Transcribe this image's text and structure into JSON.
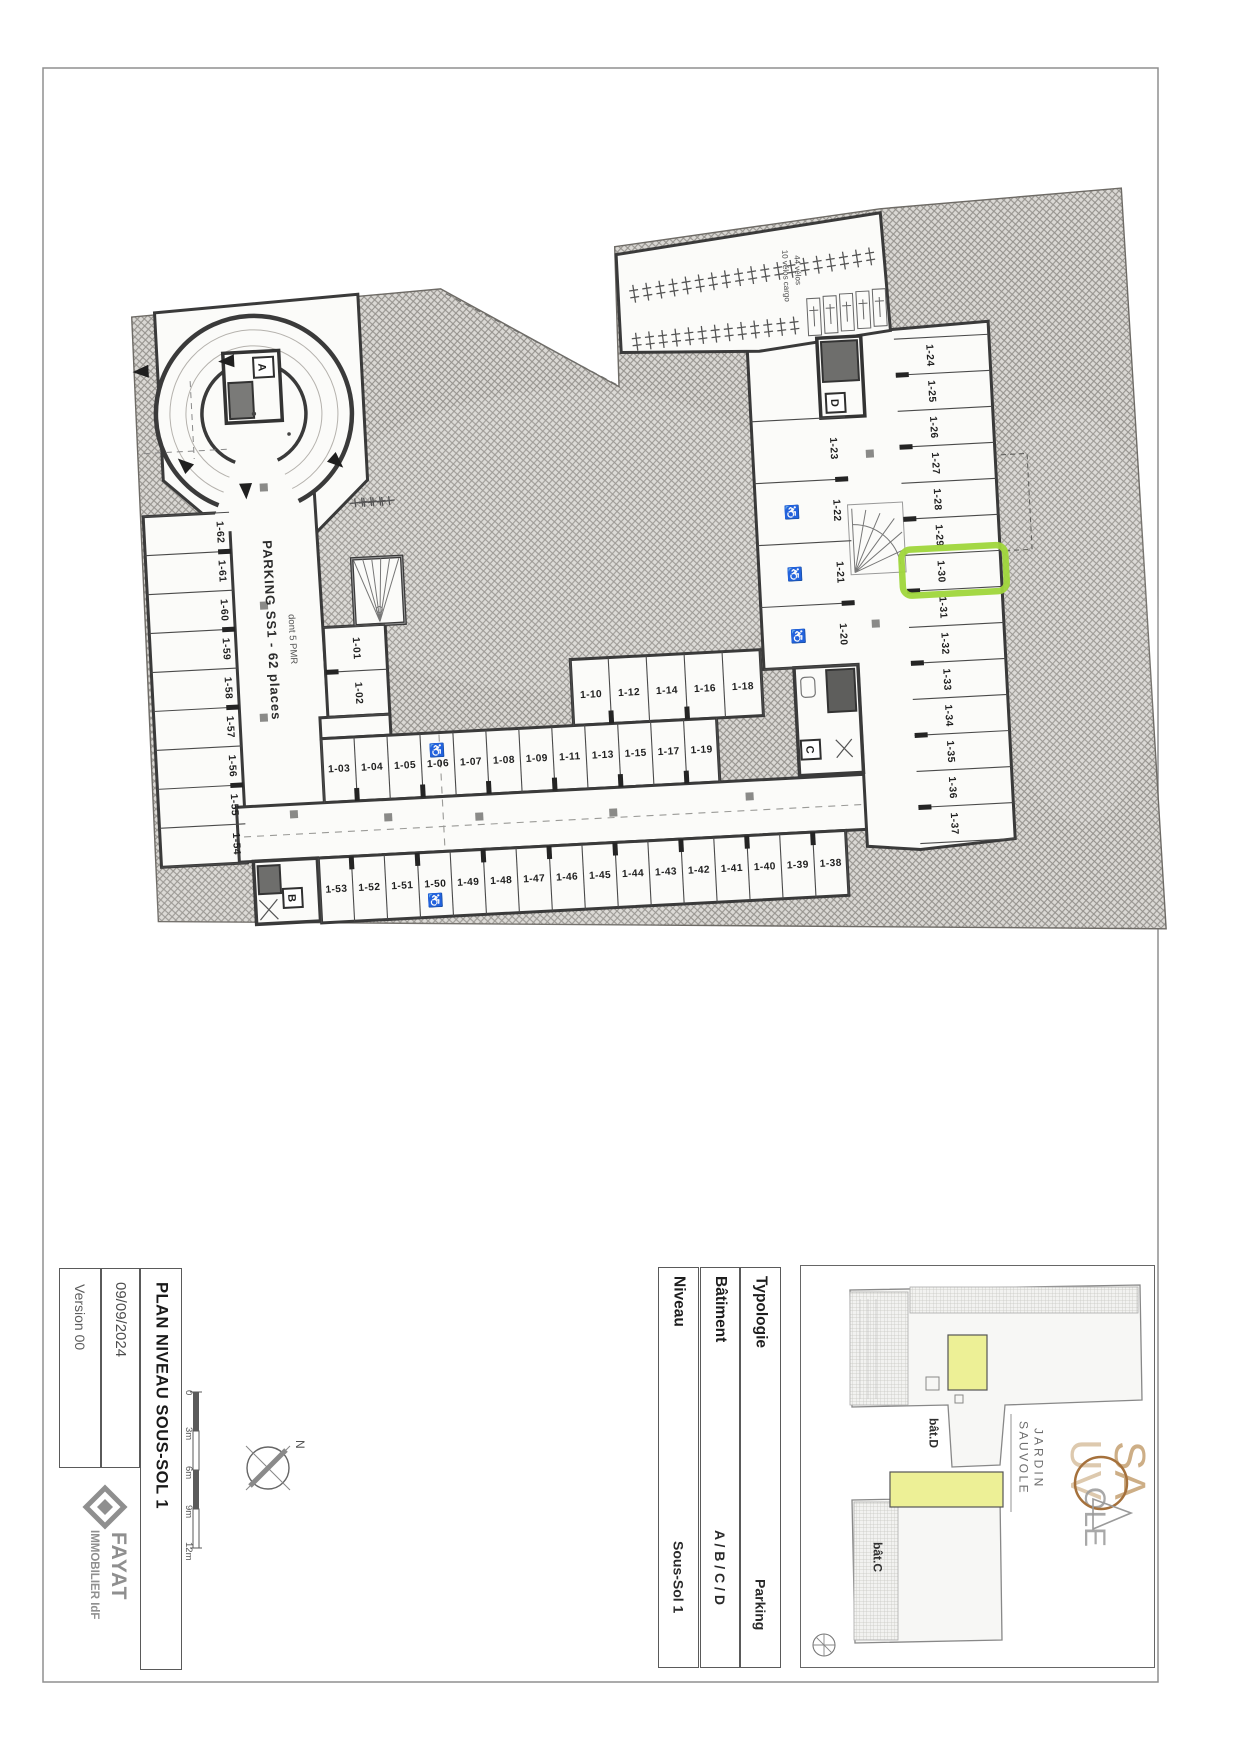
{
  "document": {
    "title": "PLAN NIVEAU SOUS-SOL 1",
    "date": "09/09/2024",
    "version": "Version 00",
    "logo": {
      "brand": "FAYAT",
      "sub": "IMMOBILIER IdF"
    },
    "scale_bar": {
      "ticks": [
        "0",
        "3m",
        "6m",
        "9m",
        "12m"
      ]
    },
    "compass_label": "N",
    "fields": [
      {
        "label": "Typologie",
        "value": "Parking"
      },
      {
        "label": "Bâtiment",
        "value": "A / B / C / D"
      },
      {
        "label": "Niveau",
        "value": "Sous-Sol 1"
      }
    ],
    "key_plan": {
      "labels": [
        "bât.D",
        "bât.C"
      ],
      "highlight_color": "#edf096"
    },
    "project_logo": {
      "line1": "JARDIN",
      "line2": "SAUVOLE",
      "monogram": [
        "SA",
        "UV",
        "OLE"
      ]
    }
  },
  "plan": {
    "parking_label": "PARKING SS1 - 62 places",
    "parking_sublabel": "dont 5 PMR",
    "bike_labels": [
      "10 vélos cargo",
      "44 vélos"
    ],
    "highlighted_space": "1-30",
    "highlight_color": "#9fd63b",
    "cores": [
      "A",
      "B",
      "C",
      "D"
    ],
    "stall_groups": {
      "left_column": [
        "1-62",
        "1-61",
        "1-60",
        "1-59",
        "1-58",
        "1-57",
        "1-56",
        "1-55",
        "1-54"
      ],
      "upper_pair": [
        "1-01",
        "1-02"
      ],
      "row_upper": [
        "1-10",
        "1-12",
        "1-14",
        "1-16",
        "1-18"
      ],
      "row_main": [
        "1-03",
        "1-04",
        "1-05",
        "1-06",
        "1-07",
        "1-08",
        "1-09",
        "1-11",
        "1-13",
        "1-15",
        "1-17",
        "1-19"
      ],
      "bottom_row": [
        "1-53",
        "1-52",
        "1-51",
        "1-50",
        "1-49",
        "1-48",
        "1-47",
        "1-46",
        "1-45",
        "1-44",
        "1-43",
        "1-42",
        "1-41",
        "1-40",
        "1-39",
        "1-38"
      ],
      "inner_column": [
        "1-23",
        "1-22",
        "1-21",
        "1-20"
      ],
      "right_column": [
        "1-24",
        "1-25",
        "1-26",
        "1-27",
        "1-28",
        "1-29",
        "1-30",
        "1-31",
        "1-32",
        "1-33",
        "1-34",
        "1-35",
        "1-36",
        "1-37"
      ]
    },
    "pmr_spaces": [
      "1-06",
      "1-50",
      "1-22",
      "1-21",
      "1-20"
    ]
  }
}
